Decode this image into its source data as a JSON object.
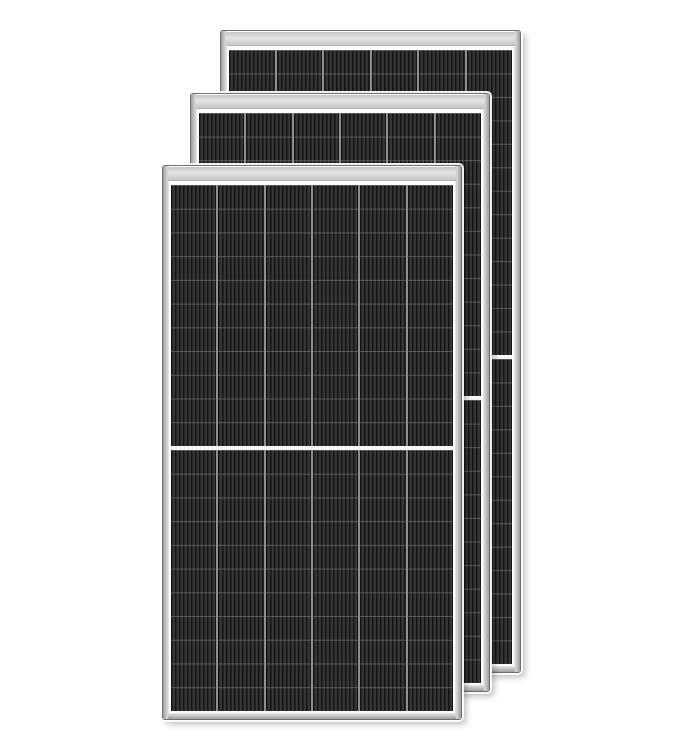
{
  "scene": {
    "type": "product-photo",
    "subject": "Three black monocrystalline half-cut solar PV modules with silver aluminum frames, stacked front to back, slightly offset, on a plain white background",
    "background_color": "#ffffff",
    "panel_count": 3,
    "colors": {
      "frame_outline": "#6f6f6f",
      "rail_dark": "#9e9e9e",
      "rail_light": "#e9e9e9",
      "flange_light": "#e4e4e4",
      "flange_dark": "#c6c6c6",
      "cell_base": "#2a2a2a",
      "stripe_dark": "#141414",
      "stripe_light": "#353535",
      "row_line": "rgba(165,165,165,0.38)",
      "column_divider": "#8f8f8f",
      "half_divider": "#f5f5f5",
      "glass_margin": "#ffffff"
    },
    "panels": [
      {
        "name": "back",
        "left": 220,
        "top": 30,
        "width": 301,
        "height": 643,
        "columns": 6,
        "rows_per_half": 13,
        "z": 1
      },
      {
        "name": "middle",
        "left": 190,
        "top": 93,
        "width": 300,
        "height": 599,
        "columns": 6,
        "rows_per_half": 12,
        "z": 2
      },
      {
        "name": "front",
        "left": 162,
        "top": 165,
        "width": 300,
        "height": 555,
        "columns": 6,
        "rows_per_half": 11,
        "z": 3
      }
    ]
  }
}
